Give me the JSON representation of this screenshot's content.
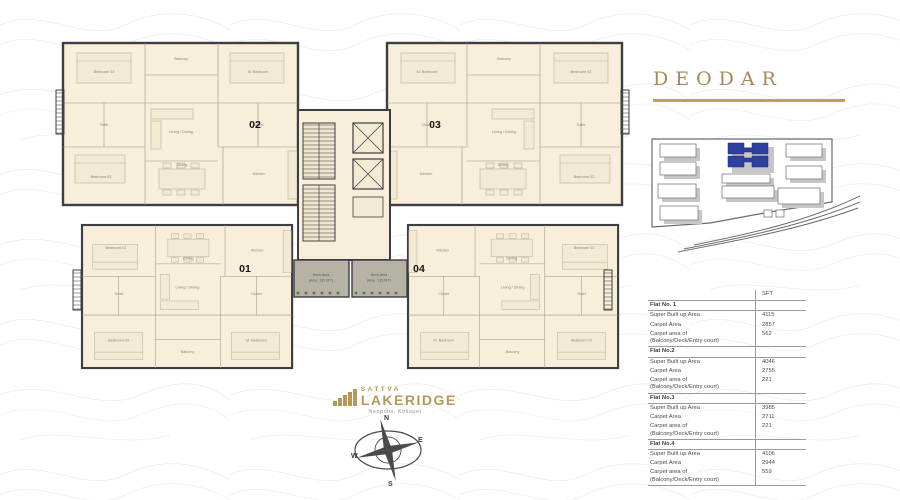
{
  "title": {
    "text": "DEODAR"
  },
  "logo": {
    "brand": "SATTVA",
    "name": "LAKERIDGE",
    "subtitle": "Neopolis, Kokapet"
  },
  "compass": {
    "n": "N",
    "e": "E",
    "s": "S",
    "w": "W"
  },
  "plan": {
    "units": {
      "u1": "01",
      "u2": "02",
      "u3": "03",
      "u4": "04"
    },
    "rooms": {
      "bedroom3": "Bedroom 03",
      "bedroom2": "Bedroom 02",
      "m_bedroom": "M. Bedroom",
      "balcony": "Balcony",
      "living": "Living / Dining",
      "toilet": "Toilet",
      "closet": "Closet",
      "dining": "Dining",
      "kitchen": "Kitchen"
    },
    "deck": {
      "line1": "Deck Area",
      "line2": "(Area : 135 SFT)"
    }
  },
  "table": {
    "sft_header": "SFT",
    "labels": {
      "sba": "Super Built up Area",
      "carpet": "Carpet Area",
      "balcony1": "Carpet area of",
      "balcony2": "(Balcony/Deck/Entry court)"
    },
    "flats": [
      {
        "name": "Flat No. 1",
        "sba": "4115",
        "carpet": "2857",
        "balcony": "562"
      },
      {
        "name": "Flat No.2",
        "sba": "4046",
        "carpet": "2755",
        "balcony": "221"
      },
      {
        "name": "Flat No.3",
        "sba": "3985",
        "carpet": "2711",
        "balcony": "221"
      },
      {
        "name": "Flat No.4",
        "sba": "4106",
        "carpet": "2944",
        "balcony": "559"
      }
    ]
  },
  "colors": {
    "gold": "#b5985a",
    "cream": "#f7efda",
    "wall": "#3d3d44",
    "deck_green": "#3e6b35",
    "highlight_blue": "#2e3f9f"
  }
}
